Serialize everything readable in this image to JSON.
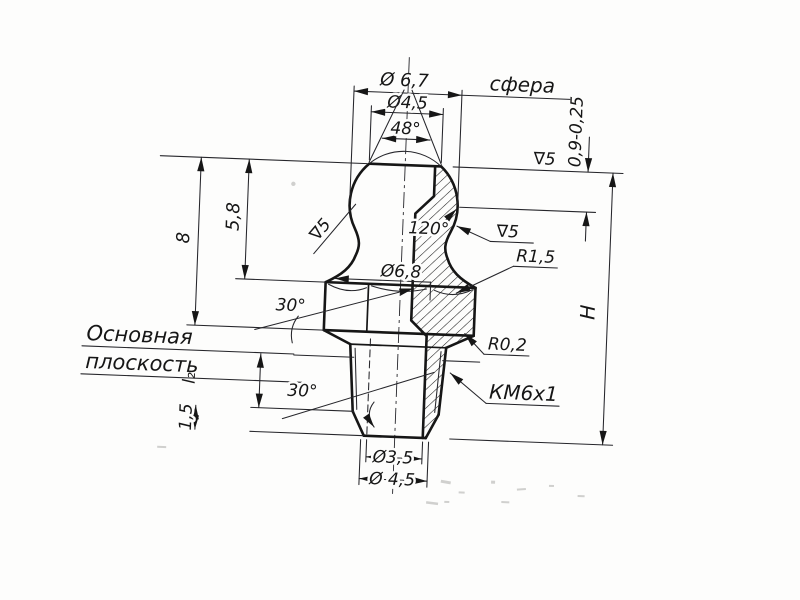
{
  "colors": {
    "ink": "#161616",
    "paper": "#fdfdfc"
  },
  "labels": {
    "top": {
      "sphere_dia": "Ø 6,7",
      "sphere_note": "сфера",
      "flat_dia": "Ø4,5",
      "cone_angle": "48°",
      "cap_height": "0,9-0,25",
      "finish_top": "∇5"
    },
    "head": {
      "seat_angle": "120°",
      "finish_seat": "∇5",
      "finish_neck": "∇5",
      "neck_radius": "R1,5",
      "hex_dia": "Ø6,8",
      "chamfer_hex": "30°"
    },
    "left": {
      "height_to_hex_bottom": "8",
      "height_to_shoulder": "5,8",
      "base_plane_line1": "Основная",
      "base_plane_line2": "плоскость",
      "l2": "l₂",
      "tip_chamfer_height": "1,5",
      "tip_chamfer_angle": "30°"
    },
    "right": {
      "relief_radius": "R0,2",
      "thread": "КМ6х1",
      "overall_height": "H"
    },
    "bottom": {
      "bore_dia": "Ø3,5",
      "end_dia": "Ø 4,5"
    }
  }
}
